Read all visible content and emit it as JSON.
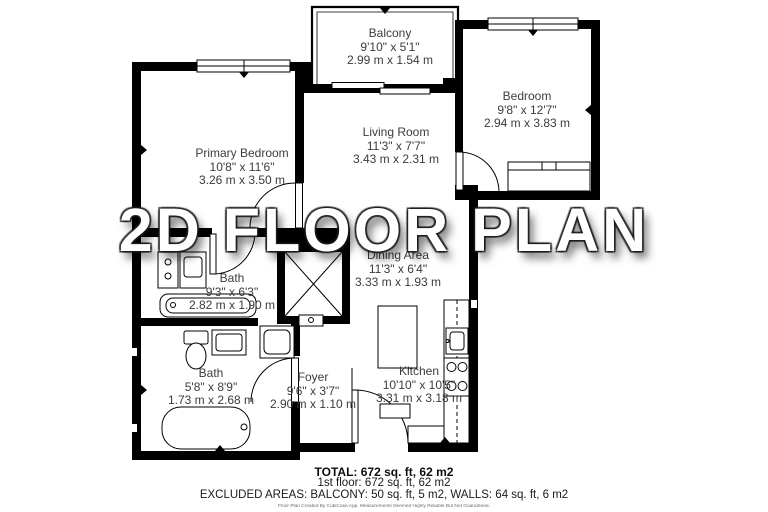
{
  "watermark": "2D FLOOR PLAN",
  "rooms": {
    "balcony": {
      "name": "Balcony",
      "imperial": "9'10\" x 5'1\"",
      "metric": "2.99 m x 1.54 m"
    },
    "bedroom": {
      "name": "Bedroom",
      "imperial": "9'8\" x 12'7\"",
      "metric": "2.94 m x 3.83 m"
    },
    "living_room": {
      "name": "Living Room",
      "imperial": "11'3\" x 7'7\"",
      "metric": "3.43 m x 2.31 m"
    },
    "primary_bedroom": {
      "name": "Primary Bedroom",
      "imperial": "10'8\" x 11'6\"",
      "metric": "3.26 m x 3.50 m"
    },
    "bath_upper": {
      "name": "Bath",
      "imperial": "9'3\" x 6'3\"",
      "metric": "2.82 m x 1.90 m"
    },
    "dining_area": {
      "name": "Dining Area",
      "imperial": "11'3\" x 6'4\"",
      "metric": "3.33 m x 1.93 m"
    },
    "bath_lower": {
      "name": "Bath",
      "imperial": "5'8\" x 8'9\"",
      "metric": "1.73 m x 2.68 m"
    },
    "foyer": {
      "name": "Foyer",
      "imperial": "9'6\" x 3'7\"",
      "metric": "2.90 m x 1.10 m"
    },
    "kitchen": {
      "name": "Kitchen",
      "imperial": "10'10\" x 10'5\"",
      "metric": "3.31 m x 3.18 m"
    }
  },
  "summary": {
    "total": "TOTAL: 672 sq. ft, 62 m2",
    "floor": "1st floor: 672 sq. ft, 62 m2",
    "excluded": "EXCLUDED AREAS: BALCONY: 50 sq. ft, 5 m2, WALLS: 64 sq. ft, 6 m2",
    "disclaimer": "Floor Plan Created By CubiCasa App. Measurements Deemed Highly Reliable But Not Guaranteed."
  },
  "colors": {
    "wall": "#000000",
    "background": "#ffffff",
    "label_text": "#3c3c3c",
    "watermark_fill": "#ffffff",
    "watermark_shadow": "#191919"
  }
}
